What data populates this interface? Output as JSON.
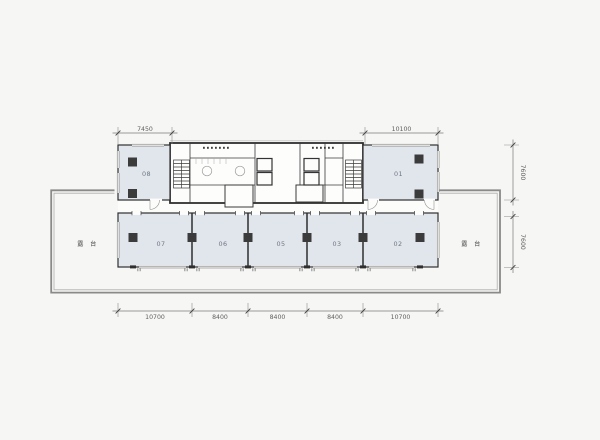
{
  "drawing": {
    "rooms": {
      "r01": "01",
      "r02": "02",
      "r03": "03",
      "r05": "05",
      "r06": "06",
      "r07": "07",
      "r08": "08"
    },
    "terrace": {
      "left": "露 台",
      "right": "露 台"
    },
    "dimensions": {
      "top_left": "7450",
      "top_right": "10100",
      "right_upper": "7600",
      "right_lower": "7600",
      "bottom": [
        "10700",
        "8400",
        "8400",
        "8400",
        "10700"
      ]
    },
    "colors": {
      "background": "#f6f6f4",
      "room_fill": "#e1e6ec",
      "wall": "#2f2f2f",
      "terrace_border": "#8a8a8a",
      "dimension": "#6f6f6f"
    }
  }
}
